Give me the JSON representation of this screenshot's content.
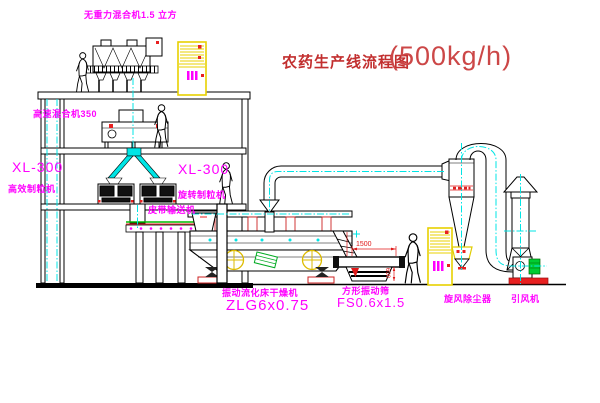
{
  "title": {
    "text": "农药生产线流程图",
    "capacity": "(500kg/h)"
  },
  "equipment_labels": {
    "zero_gravity_mixer": "无重力混合机1.5 立方",
    "high_speed_mixer": "高速混合机350",
    "granulator_left_model": "XL-300",
    "granulator_left_name": "高效制粒机",
    "granulator_right_model": "XL-300",
    "granulator_right_name": "旋转制粒机",
    "belt_conveyor": "皮带输送机",
    "dryer_name": "振动流化床干燥机",
    "dryer_model": "ZLG6x0.75",
    "screen_name": "方形振动筛",
    "screen_model": "FS0.6x1.5",
    "cyclone": "旋风除尘器",
    "induced_draft_fan": "引风机"
  },
  "dimensions": {
    "screen_length": "1500",
    "screen_height": "600"
  },
  "colors": {
    "label": "#ff00ff",
    "title": "#c22f2f",
    "centerline": "#00e5e5",
    "dimension": "#e01818",
    "cabinet": "#e8d000",
    "motor_green": "#00cc33",
    "line": "#000000",
    "background": "#ffffff"
  }
}
